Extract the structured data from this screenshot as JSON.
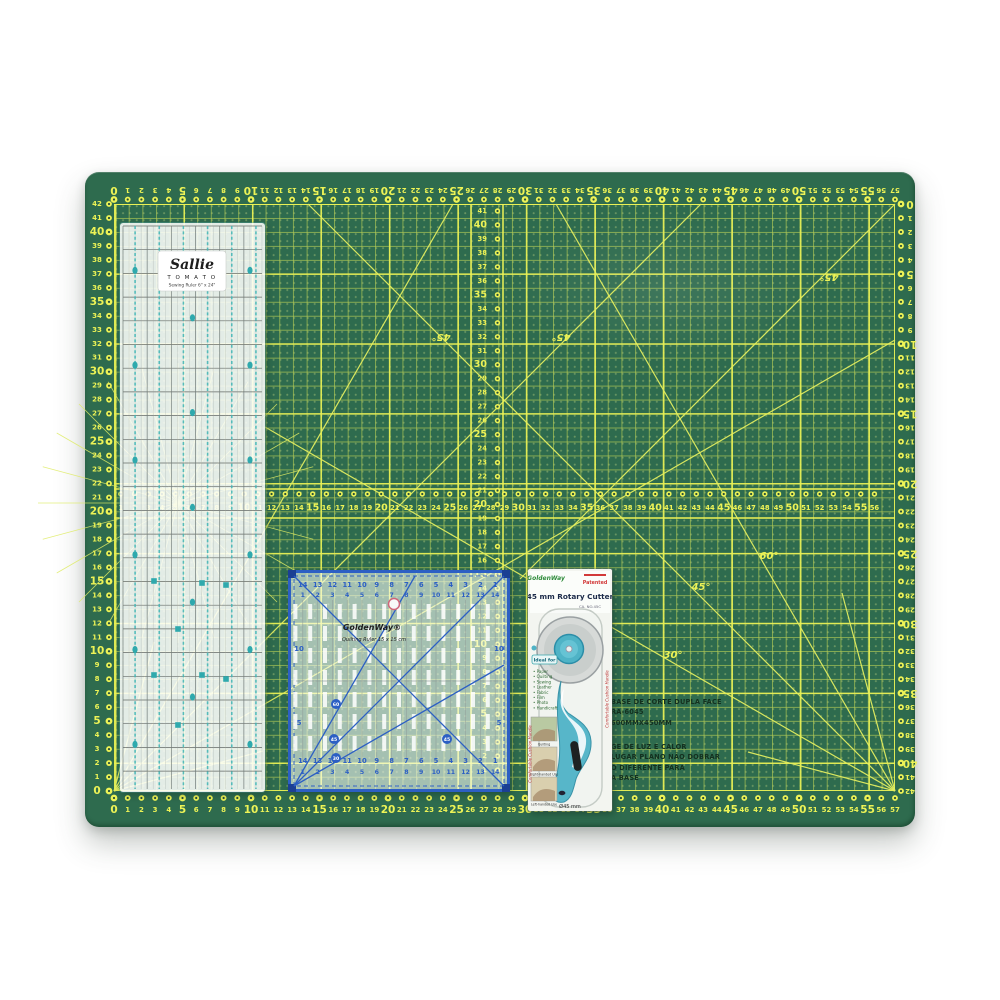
{
  "mat": {
    "green": "#2e6b4e",
    "grid_line": "#bad054",
    "accent": "#edf356",
    "circle_core": "#27503a",
    "h_scale_min": 0,
    "h_scale_max": 57,
    "v_scale_min": 0,
    "v_scale_max": 42,
    "mid_row_min": 1,
    "mid_row_max": 56,
    "mid_col_min": 1,
    "mid_col_max": 41,
    "diagonals": [
      [
        895,
        791,
        308,
        204
      ],
      [
        895,
        791,
        556,
        204
      ],
      [
        895,
        791,
        265,
        427
      ],
      [
        114,
        791,
        701,
        204
      ],
      [
        114,
        791,
        453,
        204
      ],
      [
        114,
        791,
        895,
        340
      ],
      [
        895,
        204,
        520,
        579
      ],
      [
        895,
        791,
        842,
        593
      ],
      [
        895,
        791,
        748,
        752
      ],
      [
        114,
        791,
        263,
        751
      ],
      [
        114,
        791,
        154,
        642
      ]
    ],
    "starburst": {
      "x": 178,
      "y": 503,
      "r": 140,
      "step": 15
    },
    "angle_labels": [
      {
        "t": "45°",
        "x": 441,
        "y": 334,
        "rot": 180
      },
      {
        "t": "45°",
        "x": 561,
        "y": 334,
        "rot": 180
      },
      {
        "t": "45°",
        "x": 829,
        "y": 274,
        "rot": 180
      },
      {
        "t": "45°",
        "x": 701,
        "y": 590,
        "rot": 0
      },
      {
        "t": "60°",
        "x": 769,
        "y": 559,
        "rot": 0
      },
      {
        "t": "30°",
        "x": 673,
        "y": 658,
        "rot": 0
      }
    ],
    "print1": [
      "BASE DE CORTE DUPLA FACE",
      "RA-6045",
      "600MMX450MM"
    ],
    "print2": [
      "GE DE LUZ E CALOR",
      "LUGAR PLANO NÃO DOBRAR",
      "O DIFERENTE PARA",
      "A BASE"
    ]
  },
  "long_ruler": {
    "brand_script": "Sallie",
    "brand_caps": "T O M A T O",
    "subtitle": "Sewing Ruler 6\" x 24\""
  },
  "square_ruler": {
    "brand": "GoldenWay®",
    "subtitle": "Quilting Ruler 15 x 15 cm",
    "numbers_desc": [
      14,
      13,
      12,
      11,
      10,
      9,
      8,
      7,
      6,
      5,
      4,
      3,
      2,
      1
    ],
    "numbers_asc": [
      1,
      2,
      3,
      4,
      5,
      6,
      7,
      8,
      9,
      10,
      11,
      12,
      13,
      14
    ],
    "side_label_ten": "10",
    "side_label_five": "5",
    "angle_dots": [
      {
        "t": "60",
        "x": 48,
        "y": 134
      },
      {
        "t": "45",
        "x": 46,
        "y": 169
      },
      {
        "t": "30",
        "x": 48,
        "y": 188
      },
      {
        "t": "45",
        "x": 159,
        "y": 169
      }
    ]
  },
  "cutter": {
    "brand": "GoldenWay",
    "patented": "Patented",
    "title": "45 mm Rotary Cutter",
    "catalog": "CA. NO.45C",
    "ideal_title": "Ideal for",
    "ideal_for": [
      "Paper",
      "Quilting",
      "Sewing",
      "Leather",
      "Fabric",
      "Film",
      "Photo",
      "Handicraft"
    ],
    "captions": [
      "Quilting",
      "Right-handed Use",
      "Left-handed Use"
    ],
    "side_text": "Comfortable Cushion Handle",
    "diameter": "Ø45 mm"
  }
}
